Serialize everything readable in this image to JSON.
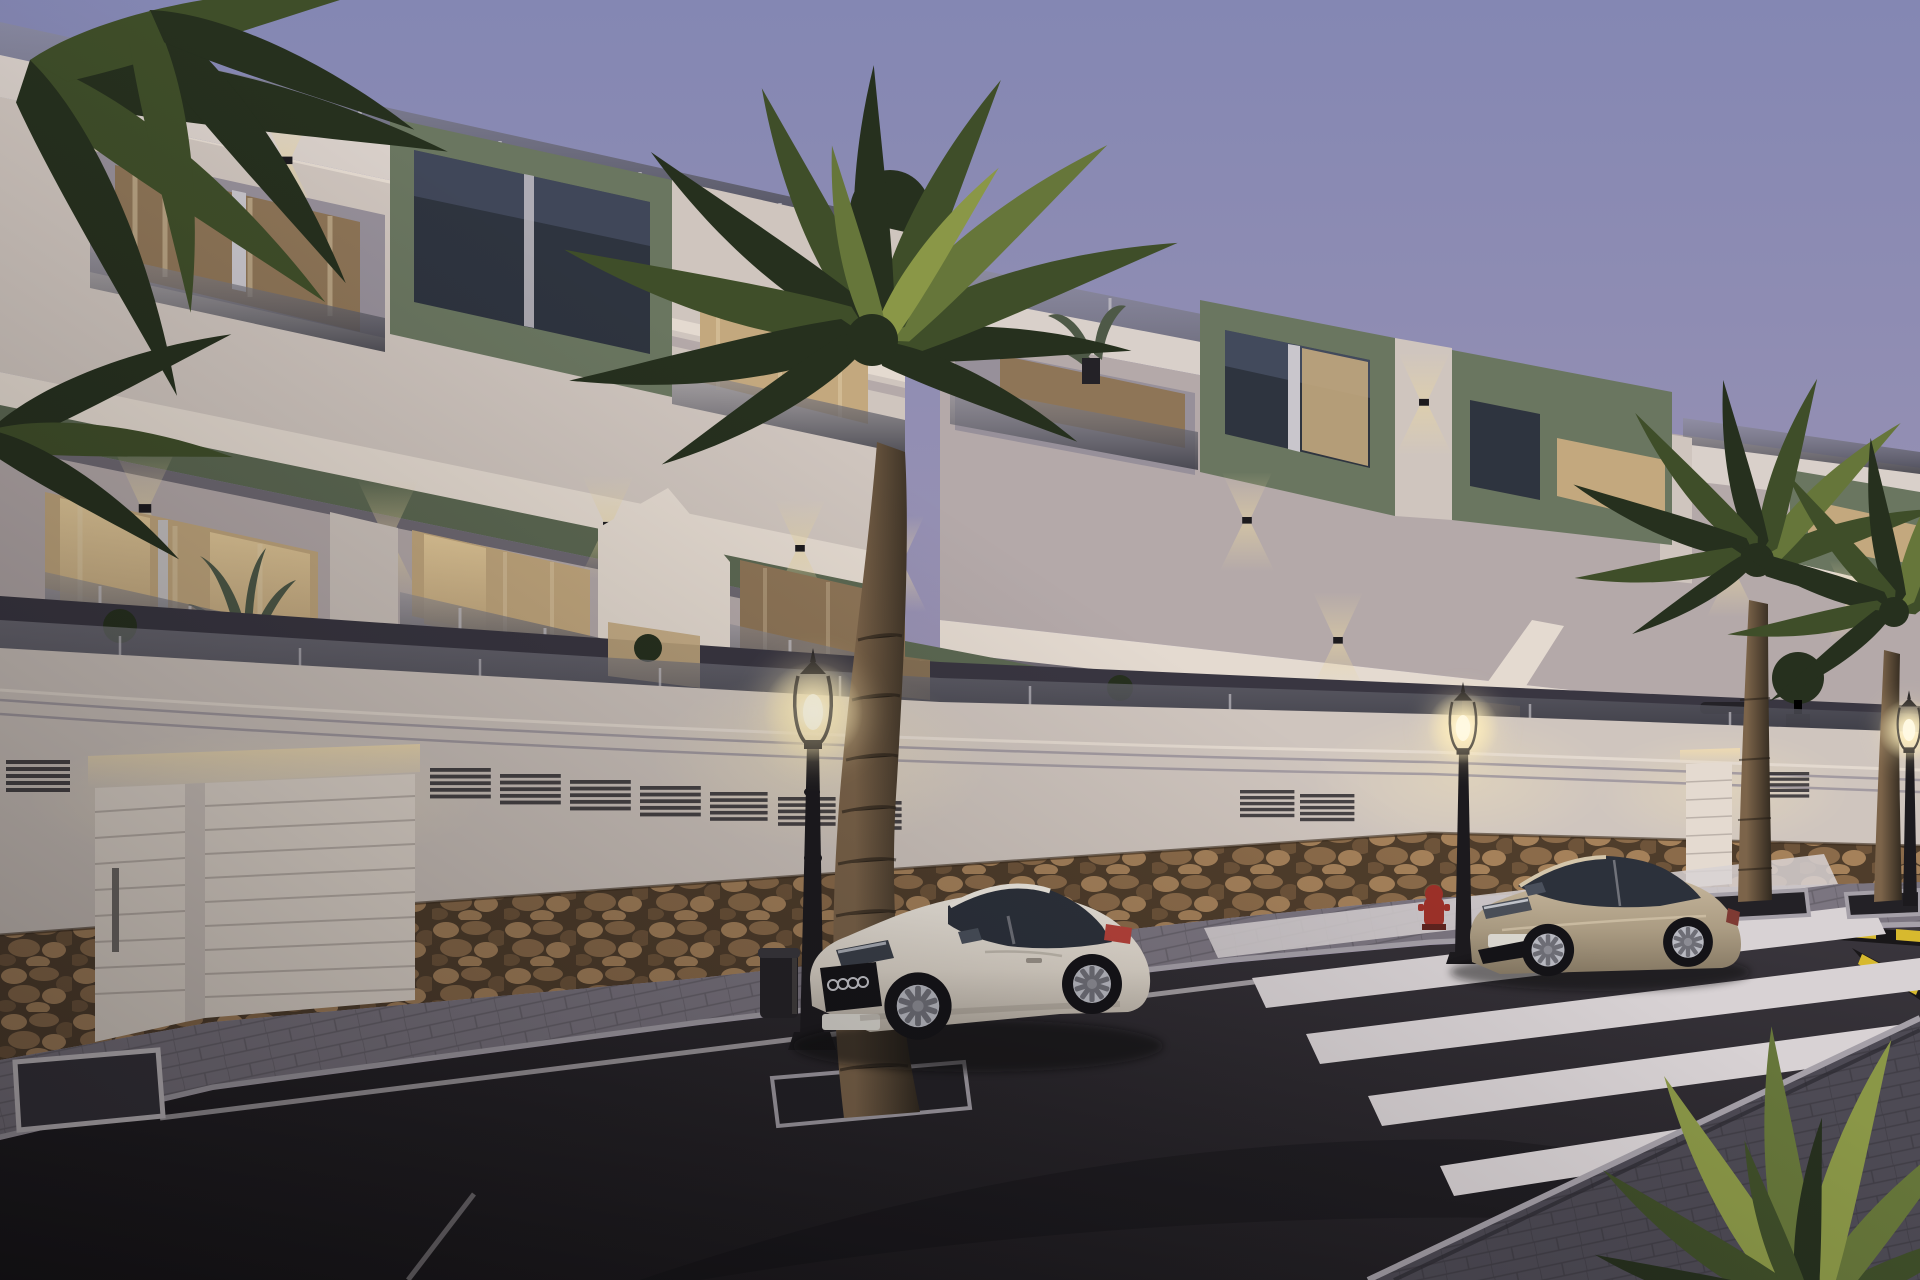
{
  "scene": {
    "type": "exterior-architectural-render",
    "time_of_day": "dusk",
    "description": "New-build Mediterranean apartment complex at dusk: three stepped white blocks with olive-green accent volumes, glass balustrades, warm lit interiors, stone-clad street wall with garages, palm trees, two parked coupes, classic street lamps and a zebra crosswalk.",
    "objects": {
      "buildings": 3,
      "palm_trees": 5,
      "street_lamps": 3,
      "garage_doors": 2,
      "cars": [
        {
          "type": "coupe",
          "color_name": "white",
          "facing": "left"
        },
        {
          "type": "coupe",
          "color_name": "beige",
          "facing": "left"
        }
      ],
      "crosswalk": true,
      "fire_hydrant": true,
      "trash_bin": true,
      "traffic_island": true,
      "yellow_black_curb_marking": true
    }
  },
  "palette": {
    "sky_top": "#8487b3",
    "sky_mid": "#9b93b3",
    "sky_horizon": "#b7a8b1",
    "facade_lightest": "#e4dad0",
    "facade_light": "#cfc5be",
    "facade_mid": "#b4a9a9",
    "facade_shadow": "#97909a",
    "facade_dark": "#837d88",
    "fascia_light": "#d9d0ca",
    "green_accent": "#6a7660",
    "green_dark": "#4e5947",
    "green_band": "#5c6852",
    "glass_window": "#2e343f",
    "glass_reflect": "#566079",
    "window_warm": "#ecd2a0",
    "window_warm_dim": "#c3a87e",
    "window_deep": "#8e7557",
    "curtain_light": "#e8d7b4",
    "rail_glass": "#3f3f48",
    "rail_top": "#8e8d96",
    "rail_post": "#c9c6cc",
    "slab_under": "#6e6972",
    "stone_joint": "#4f3d2b",
    "stone_a": "#a5815a",
    "stone_b": "#8b6b4a",
    "stone_c": "#6e543a",
    "road_light": "#3a363d",
    "road_dark": "#141215",
    "sidewalk_far": "#7b7580",
    "sidewalk_near": "#4d4a54",
    "curb_light": "#a5a0a8",
    "mark_white": "#c9c3c7",
    "cross_white": "#d8d2d4",
    "mark_yellow": "#d7b92e",
    "mark_black": "#191719",
    "glow_core": "#fffdf0",
    "glow_warm": "#ffedb8",
    "sconce_warm": "#e7d5a2",
    "led_warm": "#f2ddb0",
    "car_white_hi": "#f0eae1",
    "car_white": "#ddd5ca",
    "car_white_lo": "#b3aba0",
    "car_beige_hi": "#c8b89e",
    "car_beige": "#ab9c83",
    "car_beige_lo": "#857863",
    "tyre": "#141317",
    "alloy": "#b9bac2",
    "cabin_glass": "#2c313b",
    "tail_red": "#b8423a",
    "plate_light": "#dcd9d2",
    "hydrant_red": "#9e3129",
    "palm_dark": "#26301e",
    "palm_mid": "#3f4e29",
    "palm_light": "#66763a",
    "palm_lit": "#8a9747",
    "trunk_lit": "#7c644a",
    "trunk_dark": "#31291f",
    "bin_dark": "#242227",
    "shadow": "#0c0b0d"
  }
}
